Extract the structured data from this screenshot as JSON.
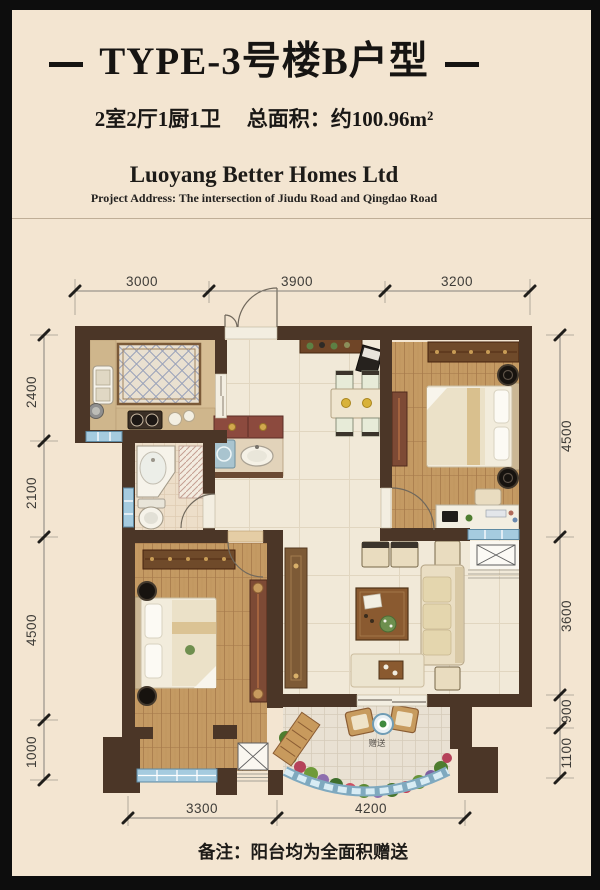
{
  "header": {
    "title": "TYPE-3号楼B户型",
    "subtitle_rooms": "2室2厅1厨1卫",
    "subtitle_area": "总面积：约100.96m²",
    "company": "Luoyang Better Homes Ltd",
    "address": "Project Address: The intersection of Jiudu Road and Qingdao Road"
  },
  "plan": {
    "dims_top": [
      "3000",
      "3900",
      "3200"
    ],
    "dims_left": [
      "2400",
      "2100",
      "4500",
      "1000"
    ],
    "dims_right": [
      "4500",
      "3600",
      "900",
      "1100"
    ],
    "dims_bottom": [
      "3300",
      "4200"
    ],
    "balcony_gift_label": "赠送"
  },
  "footer": {
    "note": "备注：阳台均为全面积赠送"
  },
  "colors": {
    "background": "#f3e5d1",
    "frame": "#0d0d0d",
    "wall": "#4b3627",
    "window_blue": "#a5cbdf",
    "wood_floor": "#c49a63",
    "marble_floor": "#f1e9d8"
  }
}
